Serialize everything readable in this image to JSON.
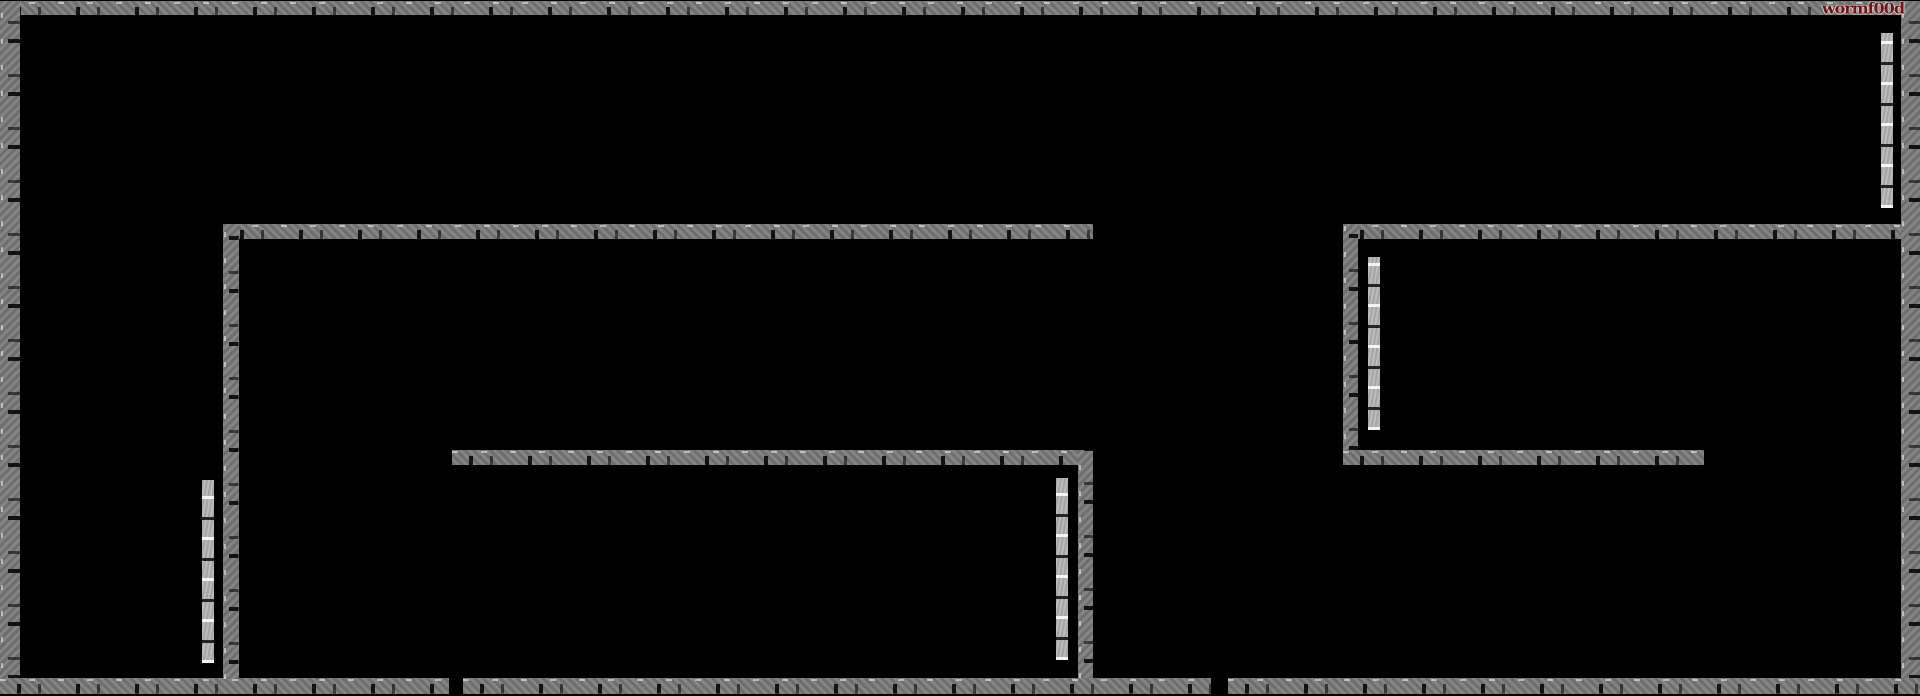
{
  "game": {
    "title": "wormf00d",
    "scene": "maze-level"
  },
  "watermark": {
    "text": "wormf00d"
  },
  "colors": {
    "background": "#000000",
    "wall_thick": "#7b7b7b",
    "wall_thin": "#b3b3b3",
    "title_fill": "#6e1414",
    "title_outline": "#d2d2d2"
  },
  "playfield": {
    "width": 1920,
    "height": 696
  },
  "walls": [
    {
      "name": "top-border-wall",
      "tone": "thick",
      "orientation": "h",
      "x": 0,
      "y": 1,
      "w": 1920,
      "h": 14
    },
    {
      "name": "left-border-wall",
      "tone": "thick",
      "orientation": "v",
      "x": 0,
      "y": 1,
      "w": 20,
      "h": 693
    },
    {
      "name": "right-border-wall",
      "tone": "thick",
      "orientation": "v",
      "x": 1901,
      "y": 1,
      "w": 19,
      "h": 693
    },
    {
      "name": "bottom-border-wall-left",
      "tone": "thick",
      "orientation": "h",
      "x": 0,
      "y": 678,
      "w": 449,
      "h": 16
    },
    {
      "name": "bottom-border-wall-middle",
      "tone": "thick",
      "orientation": "h",
      "x": 463,
      "y": 678,
      "w": 748,
      "h": 16
    },
    {
      "name": "bottom-border-wall-right",
      "tone": "thick",
      "orientation": "h",
      "x": 1228,
      "y": 678,
      "w": 692,
      "h": 16
    },
    {
      "name": "left-room-top-wall",
      "tone": "thick",
      "orientation": "h",
      "x": 223,
      "y": 224,
      "w": 870,
      "h": 15
    },
    {
      "name": "left-room-left-wall",
      "tone": "thick",
      "orientation": "v",
      "x": 223,
      "y": 224,
      "w": 16,
      "h": 455
    },
    {
      "name": "left-room-middle-wall",
      "tone": "thick",
      "orientation": "h",
      "x": 452,
      "y": 450,
      "w": 641,
      "h": 15
    },
    {
      "name": "left-room-right-wall",
      "tone": "thick",
      "orientation": "v",
      "x": 1078,
      "y": 450,
      "w": 15,
      "h": 228
    },
    {
      "name": "right-room-top-wall",
      "tone": "thick",
      "orientation": "h",
      "x": 1343,
      "y": 224,
      "w": 558,
      "h": 15
    },
    {
      "name": "right-room-left-wall",
      "tone": "thick",
      "orientation": "v",
      "x": 1343,
      "y": 224,
      "w": 15,
      "h": 241
    },
    {
      "name": "right-room-bottom-wall",
      "tone": "thick",
      "orientation": "h",
      "x": 1343,
      "y": 450,
      "w": 361,
      "h": 15
    },
    {
      "name": "left-thin-pillar-wall",
      "tone": "thin",
      "orientation": "v",
      "x": 202,
      "y": 480,
      "w": 12,
      "h": 183
    },
    {
      "name": "middle-thin-pillar-wall",
      "tone": "thin",
      "orientation": "v",
      "x": 1056,
      "y": 478,
      "w": 12,
      "h": 182
    },
    {
      "name": "right-room-thin-pillar-wall",
      "tone": "thin",
      "orientation": "v",
      "x": 1368,
      "y": 257,
      "w": 12,
      "h": 173
    },
    {
      "name": "top-right-thin-pillar-wall",
      "tone": "thin",
      "orientation": "v",
      "x": 1881,
      "y": 33,
      "w": 12,
      "h": 175
    }
  ]
}
